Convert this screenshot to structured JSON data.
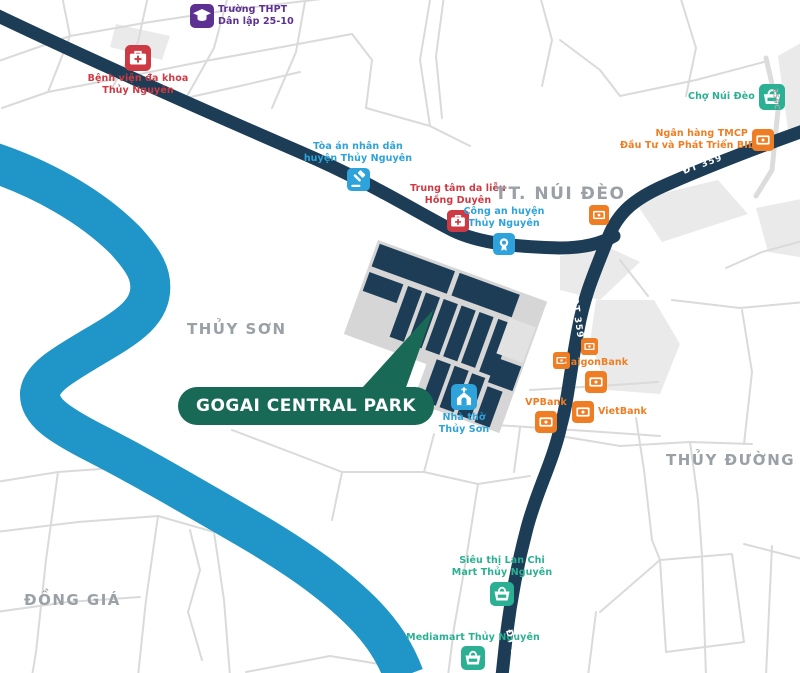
{
  "map": {
    "badge": {
      "label": "GOGAI CENTRAL PARK"
    },
    "areas": {
      "nui_deo": "TT. NÚI ĐÈO",
      "thuy_son": "THỦY SƠN",
      "thuy_duong": "THỦY ĐƯỜNG",
      "dong_gia": "ĐỒNG GIÁ"
    },
    "roads": {
      "dt359": "ĐT 359",
      "r359c": "359C"
    },
    "pois": {
      "school": {
        "line1": "Trường THPT",
        "line2": "Dân lập 25-10"
      },
      "hospital": {
        "line1": "Bệnh viện đa khoa",
        "line2": "Thủy Nguyên"
      },
      "court": {
        "line1": "Tòa án nhân dân",
        "line2": "huyện Thủy Nguyên"
      },
      "derm": {
        "line1": "Trung tâm da liễu",
        "line2": "Hồng Duyên"
      },
      "police": {
        "line1": "Công an huyện",
        "line2": "Thủy Nguyên"
      },
      "market": {
        "label": "Chợ Núi Đèo"
      },
      "bidv": {
        "line1": "Ngân hàng TMCP",
        "line2": "Đầu Tư và Phát Triển BIDV"
      },
      "church": {
        "line1": "Nhà thờ",
        "line2": "Thủy Sơn"
      },
      "saigonbank": {
        "label": "SaigonBank"
      },
      "vpbank": {
        "label": "VPBank"
      },
      "vietbank": {
        "label": "VietBank"
      },
      "lanchi": {
        "line1": "Siêu thị Lan Chi",
        "line2": "Mart Thủy Nguyên"
      },
      "mediamart": {
        "label": "Mediamart Thủy Nguyên"
      }
    },
    "colors": {
      "navy_road": "#1d3c55",
      "river_blue": "#2095c8",
      "badge_green": "#186a57",
      "poi_blue": "#2ea2da",
      "poi_red": "#cd3a43",
      "poi_purple": "#5d3191",
      "poi_teal": "#2bb093",
      "poi_orange": "#ee7d23",
      "area_label_gray": "#9aa0a6",
      "minor_road_gray": "#dadada"
    }
  }
}
